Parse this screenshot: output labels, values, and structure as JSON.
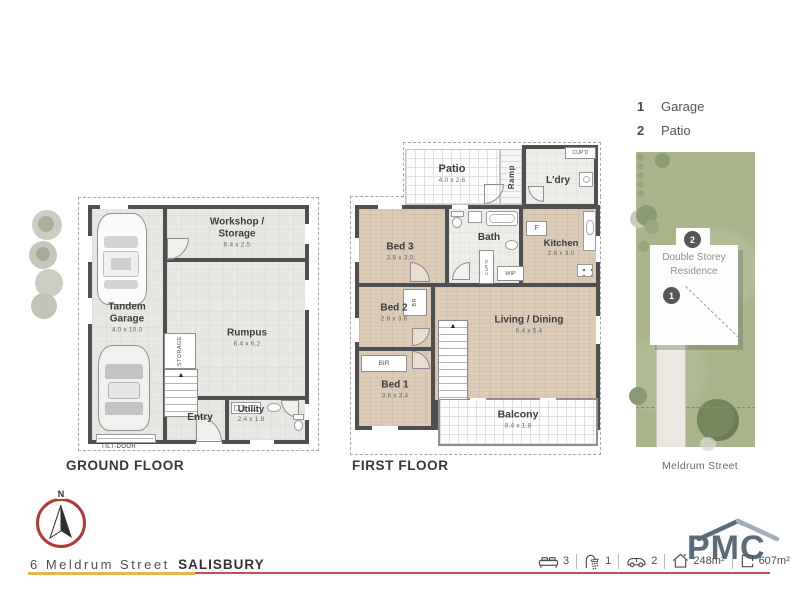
{
  "colors": {
    "wall": "#4f4f4f",
    "wood_floor": "#dbcbb7",
    "concrete_floor": "#e8e7e3",
    "lawn_green": "#a9b48a",
    "brand_slate": "#5c6b7a",
    "brand_roof_light": "#a3aeb8",
    "accent_red": "#c34f4f",
    "accent_gold": "#e6b54c",
    "compass_red": "#b23a33"
  },
  "legend": {
    "items": [
      {
        "num": "1",
        "label": "Garage"
      },
      {
        "num": "2",
        "label": "Patio"
      }
    ]
  },
  "ground_floor": {
    "title": "GROUND FLOOR",
    "garage_name": "Tandem Garage",
    "garage_dim": "4.0 x 10.0",
    "workshop_name": "Workshop / Storage",
    "workshop_dim": "6.4 x 2.5",
    "rumpus_name": "Rumpus",
    "rumpus_dim": "6.4 x 6.2",
    "entry_name": "Entry",
    "utility_name": "Utility",
    "utility_dim": "2.4 x 1.8",
    "storage_label": "STORAGE",
    "tilt_door_label": "TILT-DOOR"
  },
  "first_floor": {
    "title": "FIRST FLOOR",
    "patio_name": "Patio",
    "patio_dim": "4.0 x 2.6",
    "ramp_label": "Ramp",
    "cupd_top_label": "CUP'D",
    "ldry_name": "L'dry",
    "fridge_label": "F",
    "bed3_name": "Bed 3",
    "bed3_dim": "3.8 x 3.0",
    "bath_name": "Bath",
    "kitchen_name": "Kitchen",
    "kitchen_dim": "2.6 x 3.0",
    "bed2_name": "Bed 2",
    "bed2_dim": "2.8 x 3.6",
    "br_label": "BR",
    "cupd_mid_label": "CUP'D",
    "wip_label": "WIP",
    "living_name": "Living / Dining",
    "living_dim": "6.4 x 5.4",
    "bir_label": "BIR",
    "bed1_name": "Bed 1",
    "bed1_dim": "3.6 x 3.4",
    "balcony_name": "Balcony",
    "balcony_dim": "8.4 x 1.8"
  },
  "site_plan": {
    "badge_patio": "2",
    "badge_garage": "1",
    "residence_label": "Double Storey Residence",
    "street_label": "Meldrum Street"
  },
  "compass": {
    "north_label": "N"
  },
  "footer": {
    "address_street": "6 Meldrum Street",
    "address_suburb": "SALISBURY",
    "stats": [
      {
        "icon": "bed-icon",
        "value": "3"
      },
      {
        "icon": "shower-icon",
        "value": "1"
      },
      {
        "icon": "car-icon",
        "value": "2"
      },
      {
        "icon": "house-area-icon",
        "value": "248m²"
      },
      {
        "icon": "land-area-icon",
        "value": "607m²"
      }
    ],
    "brand_name": "PMC"
  }
}
